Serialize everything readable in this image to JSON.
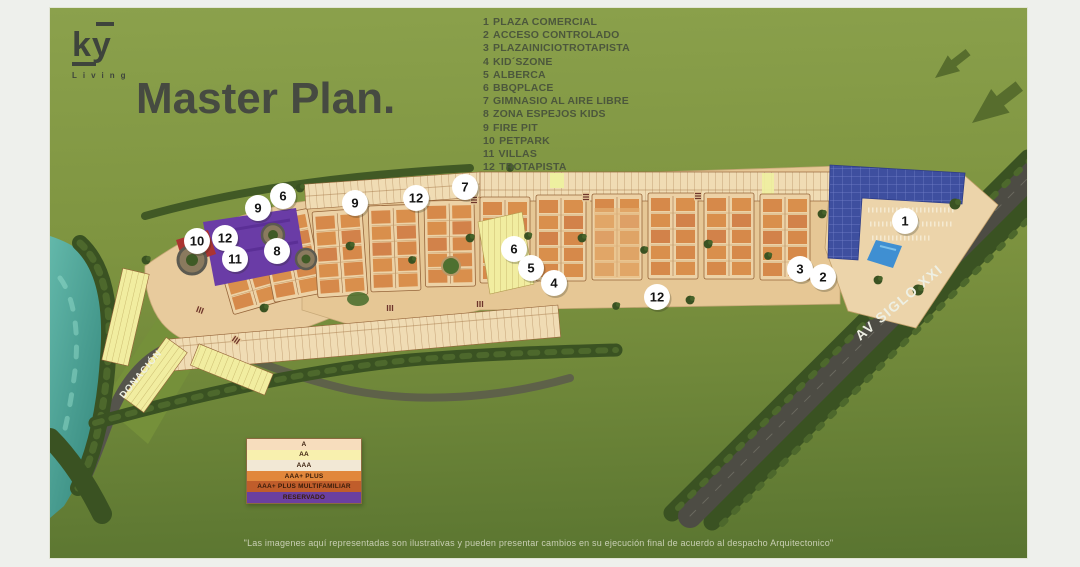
{
  "brand": {
    "name": "ky",
    "tagline": "Living"
  },
  "title": "Master Plan.",
  "amenities": [
    {
      "num": "1",
      "label": "PLAZA COMERCIAL"
    },
    {
      "num": "2",
      "label": "ACCESO CONTROLADO"
    },
    {
      "num": "3",
      "label": "PLAZAINICIOTROTAPISTA"
    },
    {
      "num": "4",
      "label": "KID´SZONE"
    },
    {
      "num": "5",
      "label": "ALBERCA"
    },
    {
      "num": "6",
      "label": "BBQPLACE"
    },
    {
      "num": "7",
      "label": "GIMNASIO AL AIRE LIBRE"
    },
    {
      "num": "8",
      "label": "ZONA ESPEJOS KIDS"
    },
    {
      "num": "9",
      "label": "FIRE PIT"
    },
    {
      "num": "10",
      "label": "PETPARK"
    },
    {
      "num": "11",
      "label": "VILLAS"
    },
    {
      "num": "12",
      "label": "TROTAPISTA"
    }
  ],
  "map": {
    "labels": {
      "donacion": "DONACIÓN",
      "avenue": "AV SIGLO XXI"
    },
    "markers": [
      {
        "n": "6"
      },
      {
        "n": "9"
      },
      {
        "n": "12"
      },
      {
        "n": "10"
      },
      {
        "n": "11"
      },
      {
        "n": "8"
      },
      {
        "n": "9"
      },
      {
        "n": "12"
      },
      {
        "n": "7"
      },
      {
        "n": "6"
      },
      {
        "n": "5"
      },
      {
        "n": "4"
      },
      {
        "n": "12"
      },
      {
        "n": "3"
      },
      {
        "n": "2"
      },
      {
        "n": "1"
      }
    ],
    "colors": {
      "water": "#3f9a8e",
      "trees": "#3a5222",
      "road": "#4d4c44",
      "lot": "#edd2a6",
      "building": "#d6894a",
      "reserved": "#6a3ca6",
      "solar": "#3e4f9f",
      "pool": "#3f8fd2",
      "background_green": "#7e9440"
    }
  },
  "legend": {
    "rows": [
      {
        "label": "A",
        "color": "#f7ddbd"
      },
      {
        "label": "AA",
        "color": "#f8f0ae"
      },
      {
        "label": "AAA",
        "color": "#f2e8d5"
      },
      {
        "label": "AAA+ PLUS",
        "color": "#e1873c"
      },
      {
        "label": "AAA+ PLUS MULTIFAMILIAR",
        "color": "#c05d2b"
      },
      {
        "label": "RESERVADO",
        "color": "#6b3fa0"
      }
    ]
  },
  "disclaimer": "\"Las imagenes aquí representadas son ilustrativas y pueden presentar cambios en su ejecución final de acuerdo al despacho Arquitectonico\""
}
